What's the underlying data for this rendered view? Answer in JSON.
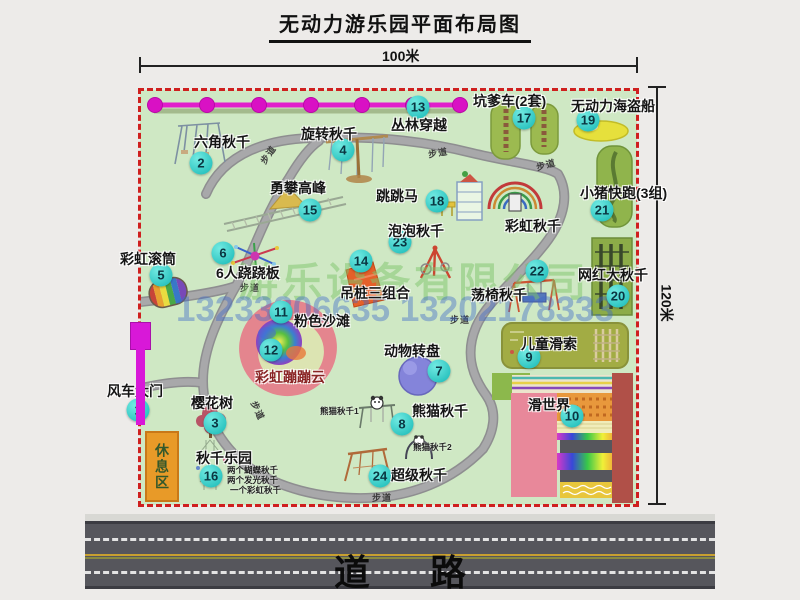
{
  "title": "无动力游乐园平面布局图",
  "dimensions": {
    "top": "100米",
    "right": "120米"
  },
  "road": {
    "label": "道路"
  },
  "watermark": {
    "company": "游乐设备有限公司",
    "phone": "13233806635 13202178333"
  },
  "rest_area": {
    "label": "休息区"
  },
  "park": {
    "walkway_label": "步道",
    "walkway_labels": [
      {
        "x": 258,
        "y": 148,
        "rot": -55
      },
      {
        "x": 428,
        "y": 146,
        "rot": -10
      },
      {
        "x": 536,
        "y": 158,
        "rot": -15
      },
      {
        "x": 240,
        "y": 281,
        "rot": 0
      },
      {
        "x": 450,
        "y": 313,
        "rot": 0
      },
      {
        "x": 248,
        "y": 404,
        "rot": 65
      },
      {
        "x": 372,
        "y": 491,
        "rot": 0
      }
    ],
    "pois": [
      {
        "num": "1",
        "label": "风车大门",
        "label_x": 107,
        "label_y": 381,
        "badge_x": 138,
        "badge_y": 410
      },
      {
        "num": "2",
        "label": "六角秋千",
        "label_x": 194,
        "label_y": 132,
        "badge_x": 201,
        "badge_y": 163
      },
      {
        "num": "3",
        "label": "樱花树",
        "label_x": 191,
        "label_y": 393,
        "badge_x": 215,
        "badge_y": 423
      },
      {
        "num": "4",
        "label": "旋转秋千",
        "label_x": 301,
        "label_y": 124,
        "badge_x": 343,
        "badge_y": 150
      },
      {
        "num": "5",
        "label": "彩虹滚筒",
        "label_x": 120,
        "label_y": 249,
        "badge_x": 161,
        "badge_y": 275
      },
      {
        "num": "6",
        "label": "6人跷跷板",
        "label_x": 216,
        "label_y": 263,
        "badge_x": 223,
        "badge_y": 253
      },
      {
        "num": "7",
        "label": "动物转盘",
        "label_x": 384,
        "label_y": 341,
        "badge_x": 439,
        "badge_y": 371
      },
      {
        "num": "8",
        "label": "熊猫秋千",
        "label_x": 412,
        "label_y": 401,
        "badge_x": 402,
        "badge_y": 424,
        "sublabels": [
          {
            "text": "熊猫秋千1",
            "x": 320,
            "y": 405
          },
          {
            "text": "熊猫秋千2",
            "x": 413,
            "y": 441
          }
        ]
      },
      {
        "num": "9",
        "label": "儿童滑索",
        "label_x": 521,
        "label_y": 334,
        "badge_x": 529,
        "badge_y": 357
      },
      {
        "num": "10",
        "label": "滑世界",
        "label_x": 528,
        "label_y": 395,
        "badge_x": 572,
        "badge_y": 416
      },
      {
        "num": "11",
        "label": "粉色沙滩",
        "label_x": 294,
        "label_y": 311,
        "badge_x": 281,
        "badge_y": 312
      },
      {
        "num": "12",
        "label": "彩虹蹦蹦云",
        "label_x": 255,
        "label_y": 367,
        "badge_x": 271,
        "badge_y": 350,
        "color": "#8a2525"
      },
      {
        "num": "13",
        "label": "丛林穿越",
        "label_x": 391,
        "label_y": 115,
        "badge_x": 418,
        "badge_y": 107
      },
      {
        "num": "14",
        "label": "吊桩三组合",
        "label_x": 340,
        "label_y": 283,
        "badge_x": 361,
        "badge_y": 261
      },
      {
        "num": "15",
        "label": "勇攀高峰",
        "label_x": 270,
        "label_y": 178,
        "badge_x": 310,
        "badge_y": 210
      },
      {
        "num": "16",
        "label": "秋千乐园",
        "label_x": 196,
        "label_y": 448,
        "badge_x": 211,
        "badge_y": 476,
        "sublabels": [
          {
            "text": "两个蝴蝶秋千",
            "x": 227,
            "y": 464
          },
          {
            "text": "两个发光秋千",
            "x": 227,
            "y": 474
          },
          {
            "text": "一个彩虹秋千",
            "x": 230,
            "y": 484
          }
        ]
      },
      {
        "num": "17",
        "label": "坑爹车(2套)",
        "label_x": 473,
        "label_y": 91,
        "badge_x": 524,
        "badge_y": 118
      },
      {
        "num": "18",
        "label": "跳跳马",
        "label_x": 376,
        "label_y": 186,
        "badge_x": 437,
        "badge_y": 201
      },
      {
        "num": "19",
        "label": "无动力海盗船",
        "label_x": 571,
        "label_y": 96,
        "badge_x": 588,
        "badge_y": 120
      },
      {
        "num": "20",
        "label": "网红大秋千",
        "label_x": 578,
        "label_y": 265,
        "badge_x": 618,
        "badge_y": 296
      },
      {
        "num": "21",
        "label": "小猪快跑(3组)",
        "label_x": 580,
        "label_y": 183,
        "badge_x": 602,
        "badge_y": 210
      },
      {
        "num": "22",
        "label": "荡椅秋千",
        "label_x": 471,
        "label_y": 285,
        "badge_x": 537,
        "badge_y": 271
      },
      {
        "num": "23",
        "label": "泡泡秋千",
        "label_x": 388,
        "label_y": 221,
        "badge_x": 400,
        "badge_y": 242
      },
      {
        "num": "24",
        "label": "超级秋千",
        "label_x": 391,
        "label_y": 465,
        "badge_x": 380,
        "badge_y": 476
      },
      {
        "label": "彩虹秋千",
        "label_x": 505,
        "label_y": 216
      }
    ]
  }
}
